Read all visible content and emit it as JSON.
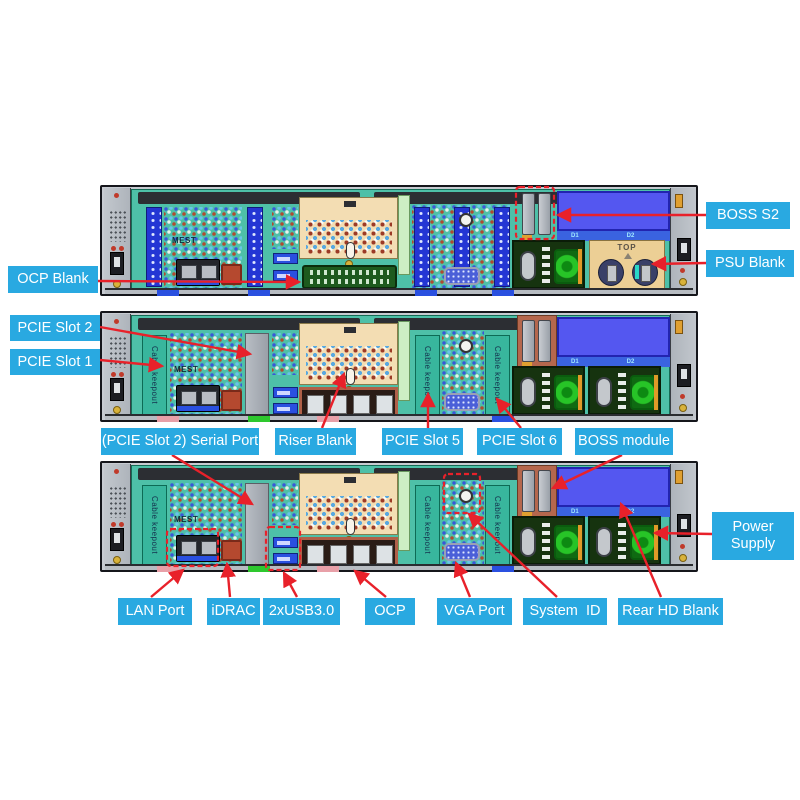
{
  "diagram_title": "Server rear view callout diagram",
  "callouts": {
    "boss_s2": {
      "label": "BOSS S2"
    },
    "psu_blank": {
      "label": "PSU Blank"
    },
    "ocp_blank": {
      "label": "OCP Blank"
    },
    "pcie_slot_2": {
      "label": "PCIE Slot 2"
    },
    "pcie_slot_1": {
      "label": "PCIE Slot 1"
    },
    "serial_port": {
      "label": "(PCIE Slot 2) Serial Port"
    },
    "riser_blank": {
      "label": "Riser Blank"
    },
    "pcie_slot_5": {
      "label": "PCIE Slot 5"
    },
    "pcie_slot_6": {
      "label": "PCIE Slot 6"
    },
    "boss_module": {
      "label": "BOSS module"
    },
    "power_supply": {
      "label": "Power\nSupply"
    },
    "lan_port": {
      "label": "LAN Port"
    },
    "idrac": {
      "label": "iDRAC"
    },
    "usb": {
      "label": "2xUSB3.0"
    },
    "ocp": {
      "label": "OCP"
    },
    "vga_port": {
      "label": "VGA Port"
    },
    "system_id": {
      "label": "System  ID"
    },
    "rear_hd_blank": {
      "label": "Rear HD Blank"
    }
  },
  "panel_texts": {
    "mest": "MEST",
    "cable_keepout": "Cable keepout area",
    "top_marking": "TOP",
    "bay_d1": "D1",
    "bay_d2": "D2"
  },
  "colors": {
    "callout_bg": "#29a9e1",
    "callout_text": "#ffffff",
    "arrow_red": "#e8212a",
    "dashed_red": "#e8212a",
    "board_teal": "#4ec0a8",
    "riser_tan": "#f3ddb3",
    "hd_blank_blue": "#5457f0",
    "psu_connector_green": "#27c427",
    "psu_blank_tan": "#eccf95",
    "riser_blank_gray": "#a9aeb6"
  }
}
